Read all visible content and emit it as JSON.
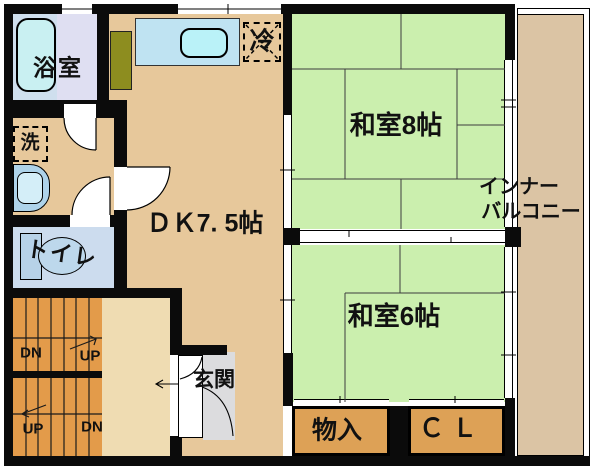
{
  "floorplan": {
    "title": "apartment-floor-plan-2f",
    "rooms": {
      "bathroom": "浴室",
      "laundry": "洗",
      "toilet": "トイレ",
      "dining_kitchen": "ＤＫ7. 5帖",
      "refrigerator": "冷",
      "japanese_room_8": "和室8帖",
      "japanese_room_6": "和室6帖",
      "inner_balcony_line1": "インナー",
      "inner_balcony_line2": "バルコニー",
      "entrance": "玄関",
      "storage": "物入",
      "closet": "ＣＬ"
    },
    "stairs": {
      "upper_left": "DN",
      "upper_right": "UP",
      "lower_left": "UP",
      "lower_right": "DN"
    },
    "colors": {
      "wall": "#0b0b0b",
      "dk_floor": "#e7c89b",
      "tatami_green": "#cbefae",
      "balcony_tan": "#dbc4a4",
      "closet_orange": "#dda156",
      "stairs_orange": "#e39b4a",
      "hall_beige": "#efdcb2",
      "bathroom_lavender": "#dfdff2",
      "toilet_blue": "#ccdcee",
      "bathtub_cyan": "#c9f0f2",
      "counter_blue": "#bfe3f2",
      "olive_counter": "#8d8d1f",
      "entrance_gray": "#dcdcde"
    }
  }
}
